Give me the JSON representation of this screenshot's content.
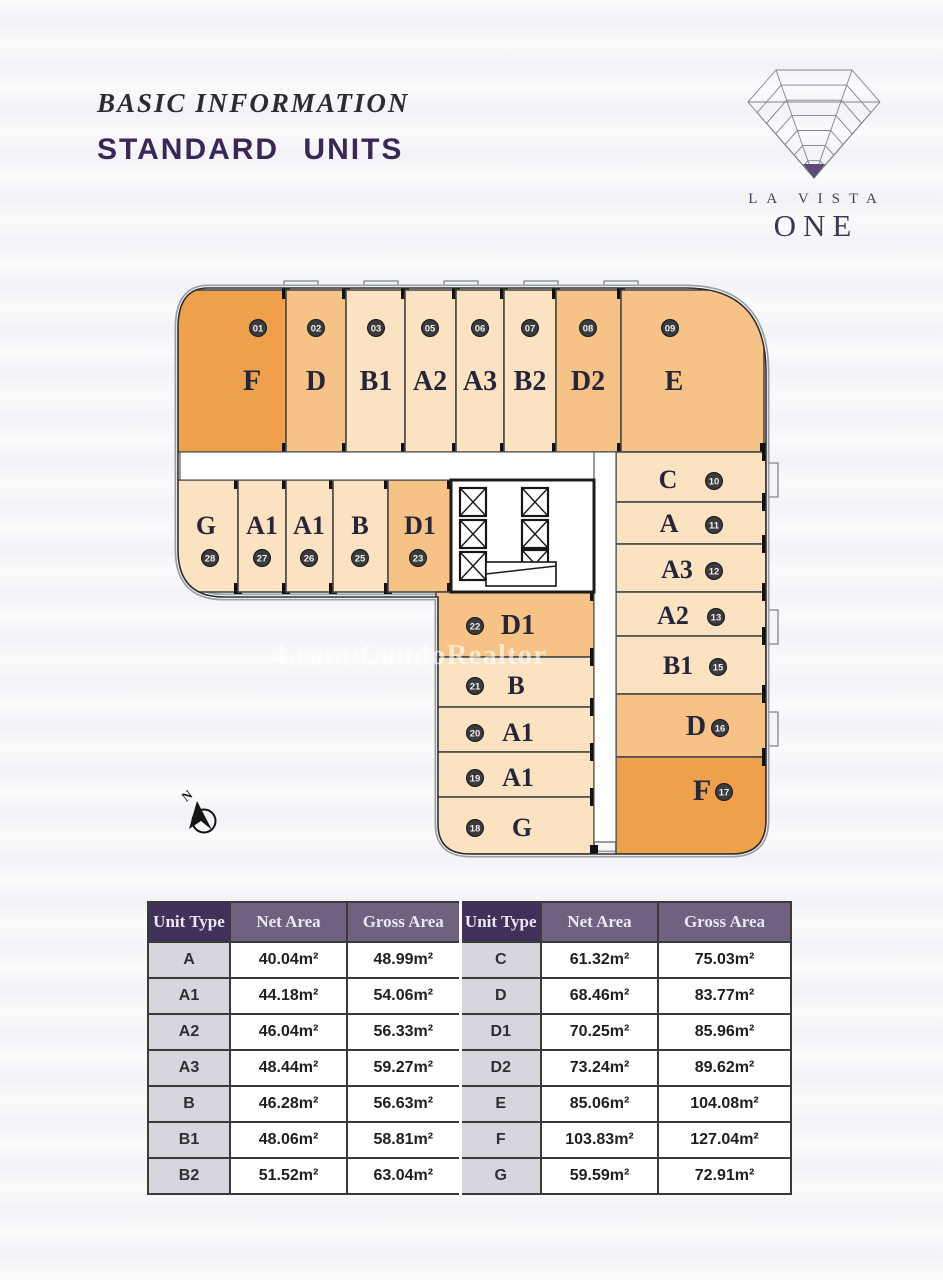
{
  "header": {
    "subtitle": "BASIC INFORMATION",
    "title": "STANDARD UNITS"
  },
  "logo": {
    "name_top": "LA VISTA",
    "name_bottom": "ONE"
  },
  "compass_label": "N",
  "watermark_text": "4.com/CondoRealtor",
  "colors": {
    "accent_purple": "#3a2757",
    "table_header_dark": "#41315a",
    "table_header_mid": "#6f6180",
    "type_cell_bg": "#d9d5de",
    "room_dark": "#efa04b",
    "room_medium": "#f6c286",
    "room_light": "#fbe3c1"
  },
  "floorplan": {
    "rooms": [
      {
        "label": "F",
        "badge": "01",
        "shade": "dark",
        "x": 10,
        "y": 10,
        "w": 110,
        "h": 162,
        "lx": 86,
        "ly": 110,
        "bx": 92,
        "by": 48,
        "fs": 30
      },
      {
        "label": "D",
        "badge": "02",
        "shade": "medium",
        "x": 120,
        "y": 10,
        "w": 60,
        "h": 162,
        "lx": 150,
        "ly": 110,
        "bx": 150,
        "by": 48,
        "fs": 28
      },
      {
        "label": "B1",
        "badge": "03",
        "shade": "light",
        "x": 180,
        "y": 10,
        "w": 59,
        "h": 162,
        "lx": 210,
        "ly": 110,
        "bx": 210,
        "by": 48,
        "fs": 28
      },
      {
        "label": "A2",
        "badge": "05",
        "shade": "light",
        "x": 239,
        "y": 10,
        "w": 51,
        "h": 162,
        "lx": 264,
        "ly": 110,
        "bx": 264,
        "by": 48,
        "fs": 28
      },
      {
        "label": "A3",
        "badge": "06",
        "shade": "light",
        "x": 290,
        "y": 10,
        "w": 48,
        "h": 162,
        "lx": 314,
        "ly": 110,
        "bx": 314,
        "by": 48,
        "fs": 28
      },
      {
        "label": "B2",
        "badge": "07",
        "shade": "light",
        "x": 338,
        "y": 10,
        "w": 52,
        "h": 162,
        "lx": 364,
        "ly": 110,
        "bx": 364,
        "by": 48,
        "fs": 28
      },
      {
        "label": "D2",
        "badge": "08",
        "shade": "medium",
        "x": 390,
        "y": 10,
        "w": 65,
        "h": 162,
        "lx": 422,
        "ly": 110,
        "bx": 422,
        "by": 48,
        "fs": 28
      },
      {
        "label": "E",
        "badge": "09",
        "shade": "medium",
        "x": 455,
        "y": 10,
        "w": 143,
        "h": 162,
        "lx": 508,
        "ly": 110,
        "bx": 504,
        "by": 48,
        "fs": 28
      },
      {
        "label": "G",
        "badge": "28",
        "shade": "light",
        "x": 10,
        "y": 200,
        "w": 62,
        "h": 112,
        "lx": 40,
        "ly": 254,
        "bx": 44,
        "by": 278,
        "fs": 26
      },
      {
        "label": "A1",
        "badge": "27",
        "shade": "light",
        "x": 72,
        "y": 200,
        "w": 48,
        "h": 112,
        "lx": 96,
        "ly": 254,
        "bx": 96,
        "by": 278,
        "fs": 26
      },
      {
        "label": "A1",
        "badge": "26",
        "shade": "light",
        "x": 120,
        "y": 200,
        "w": 47,
        "h": 112,
        "lx": 143,
        "ly": 254,
        "bx": 143,
        "by": 278,
        "fs": 26
      },
      {
        "label": "B",
        "badge": "25",
        "shade": "light",
        "x": 167,
        "y": 200,
        "w": 55,
        "h": 112,
        "lx": 194,
        "ly": 254,
        "bx": 194,
        "by": 278,
        "fs": 26
      },
      {
        "label": "D1",
        "badge": "23",
        "shade": "medium",
        "x": 222,
        "y": 200,
        "w": 63,
        "h": 112,
        "lx": 254,
        "ly": 254,
        "bx": 252,
        "by": 278,
        "fs": 26
      },
      {
        "label": "D1",
        "badge": "22",
        "shade": "medium",
        "x": 270,
        "y": 312,
        "w": 158,
        "h": 65,
        "lx": 352,
        "ly": 354,
        "bx": 309,
        "by": 346,
        "fs": 28
      },
      {
        "label": "B",
        "badge": "21",
        "shade": "light",
        "x": 270,
        "y": 377,
        "w": 158,
        "h": 50,
        "lx": 350,
        "ly": 414,
        "bx": 309,
        "by": 406,
        "fs": 26
      },
      {
        "label": "A1",
        "badge": "20",
        "shade": "light",
        "x": 270,
        "y": 427,
        "w": 158,
        "h": 45,
        "lx": 352,
        "ly": 461,
        "bx": 309,
        "by": 453,
        "fs": 26
      },
      {
        "label": "A1",
        "badge": "19",
        "shade": "light",
        "x": 270,
        "y": 472,
        "w": 158,
        "h": 45,
        "lx": 352,
        "ly": 506,
        "bx": 309,
        "by": 498,
        "fs": 26
      },
      {
        "label": "G",
        "badge": "18",
        "shade": "light",
        "x": 270,
        "y": 517,
        "w": 158,
        "h": 57,
        "lx": 356,
        "ly": 556,
        "bx": 309,
        "by": 548,
        "fs": 26
      },
      {
        "label": "C",
        "badge": "10",
        "shade": "light",
        "x": 450,
        "y": 172,
        "w": 150,
        "h": 50,
        "lx": 502,
        "ly": 208,
        "bx": 548,
        "by": 201,
        "fs": 26
      },
      {
        "label": "A",
        "badge": "11",
        "shade": "light",
        "x": 450,
        "y": 222,
        "w": 150,
        "h": 42,
        "lx": 503,
        "ly": 252,
        "bx": 548,
        "by": 245,
        "fs": 26
      },
      {
        "label": "A3",
        "badge": "12",
        "shade": "light",
        "x": 450,
        "y": 264,
        "w": 150,
        "h": 48,
        "lx": 511,
        "ly": 298,
        "bx": 548,
        "by": 291,
        "fs": 26
      },
      {
        "label": "A2",
        "badge": "13",
        "shade": "light",
        "x": 450,
        "y": 312,
        "w": 150,
        "h": 44,
        "lx": 507,
        "ly": 344,
        "bx": 550,
        "by": 337,
        "fs": 26
      },
      {
        "label": "B1",
        "badge": "15",
        "shade": "light",
        "x": 450,
        "y": 356,
        "w": 150,
        "h": 58,
        "lx": 512,
        "ly": 394,
        "bx": 552,
        "by": 387,
        "fs": 26
      },
      {
        "label": "D",
        "badge": "16",
        "shade": "medium",
        "x": 450,
        "y": 414,
        "w": 150,
        "h": 63,
        "lx": 530,
        "ly": 455,
        "bx": 554,
        "by": 448,
        "fs": 28
      },
      {
        "label": "F",
        "badge": "17",
        "shade": "dark",
        "x": 450,
        "y": 477,
        "w": 150,
        "h": 97,
        "lx": 536,
        "ly": 520,
        "bx": 558,
        "by": 512,
        "fs": 30
      }
    ]
  },
  "table": {
    "headers": [
      "Unit Type",
      "Net Area",
      "Gross Area",
      "Unit Type",
      "Net Area",
      "Gross Area"
    ],
    "rows": [
      [
        "A",
        "40.04m²",
        "48.99m²",
        "C",
        "61.32m²",
        "75.03m²"
      ],
      [
        "A1",
        "44.18m²",
        "54.06m²",
        "D",
        "68.46m²",
        "83.77m²"
      ],
      [
        "A2",
        "46.04m²",
        "56.33m²",
        "D1",
        "70.25m²",
        "85.96m²"
      ],
      [
        "A3",
        "48.44m²",
        "59.27m²",
        "D2",
        "73.24m²",
        "89.62m²"
      ],
      [
        "B",
        "46.28m²",
        "56.63m²",
        "E",
        "85.06m²",
        "104.08m²"
      ],
      [
        "B1",
        "48.06m²",
        "58.81m²",
        "F",
        "103.83m²",
        "127.04m²"
      ],
      [
        "B2",
        "51.52m²",
        "63.04m²",
        "G",
        "59.59m²",
        "72.91m²"
      ]
    ]
  }
}
